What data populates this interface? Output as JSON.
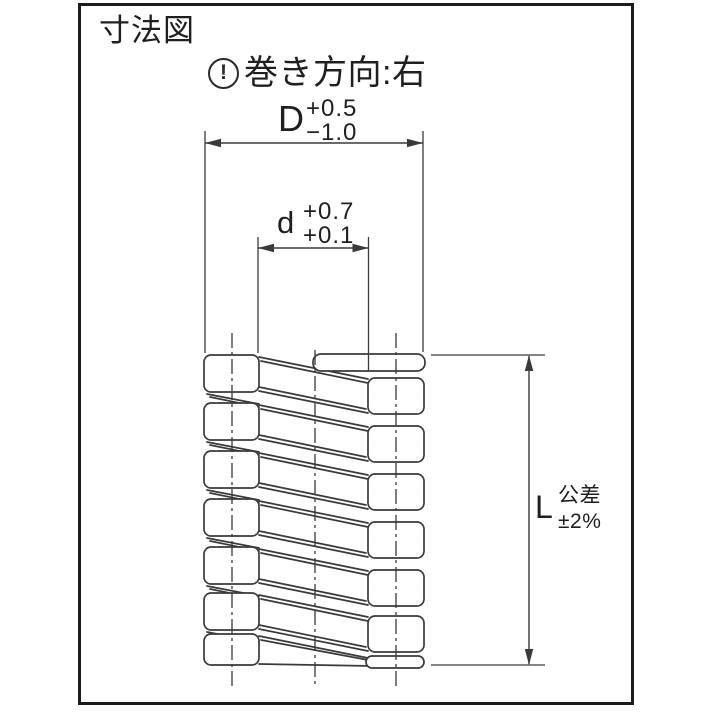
{
  "title": "寸法図",
  "winding_note": {
    "icon_glyph": "!",
    "label": "巻き方向:右"
  },
  "dimensions": {
    "outer_diameter": {
      "symbol": "D",
      "tol_upper": "+0.5",
      "tol_lower": "−1.0"
    },
    "wire_inner": {
      "symbol": "d",
      "tol_upper": "+0.7",
      "tol_lower": "+0.1"
    },
    "free_length": {
      "symbol": "L",
      "tol_label": "公差",
      "tol_value": "±2%"
    }
  },
  "colors": {
    "background": "#ffffff",
    "frame": "#1c1c1c",
    "line": "#3a3a3a",
    "text": "#1f1f1f"
  }
}
